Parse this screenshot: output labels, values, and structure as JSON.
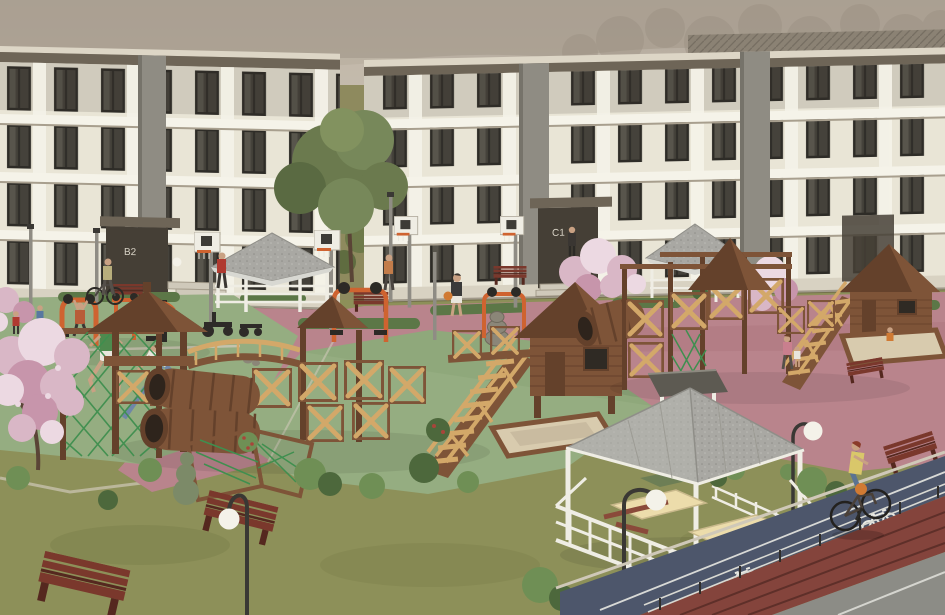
{
  "scene": {
    "title": "Residential complex courtyard - architectural 3D render",
    "description": "Courtyard of a housing estate with wooden playground complexes, outdoor gym, basketball hoops, gazebos, picnic pavilion, green and pink rubber surfaces, lawns and a bicycle path with painted bike symbols"
  },
  "labels": {
    "building_left": "B2",
    "building_center": "C1"
  },
  "palette": {
    "sky1": "#b4aa9d",
    "sky2": "#cfc5b6",
    "hill": "#a29788",
    "hillDark": "#988d7f",
    "facade": "#e9e5d6",
    "trim": "#f5f3e9",
    "roofDark": "#6e6557",
    "roofEdge": "#ddd6c6",
    "roofTile": "#8b8274",
    "winFrame": "#2e2c27",
    "winGlass": "#45423b",
    "winLite": "#6b675e",
    "column": "#8f8c83",
    "entrance": "#453f36",
    "plinth": "#d8d2c2",
    "grass": "#8d9059",
    "grassDark": "#767c46",
    "pink": "#b9848c",
    "pinkDark": "#a86f78",
    "green": "#95ad81",
    "greenDark": "#7f9a6c",
    "hedge": "#5c7747",
    "bush": "#6f8f55",
    "bushDark": "#4d683c",
    "bushGray": "#7c8a68",
    "blossom": "#d9b7c6",
    "blossomDeep": "#c795ab",
    "blossomLite": "#ecd9e2",
    "redBush": "#a8453a",
    "woodDark": "#64412b",
    "woodMid": "#7e5438",
    "woodLight": "#9a6b45",
    "woodPale": "#d3a869",
    "net": "#3f8f4f",
    "gazeboRoof": "#a9a8a3",
    "gazeboRoof2": "#999892",
    "white": "#efede4",
    "sand": "#d8cbae",
    "orange": "#cf6330",
    "black": "#2c2a26",
    "bench": "#7a382c",
    "benchDark": "#55281f",
    "pole": "#8f8c84",
    "poleDark": "#3a3834",
    "globe": "#f4f2e9",
    "path": "#4d566b",
    "pathLine": "#e8e8e2",
    "track": "#84443c",
    "trackLine": "#5e2f29",
    "roadGray": "#8c8c86",
    "skin": "#c9a183",
    "curb": "#cfc8b8",
    "stone": "#8b8678",
    "trunk": "#5a4436",
    "treeGreen": "#6b7a4e"
  },
  "objects": [
    {
      "name": "apartment-building-left",
      "label": "B2",
      "floors": 4
    },
    {
      "name": "apartment-building-center",
      "label": "C1",
      "floors": 4
    },
    {
      "name": "basketball-hoops",
      "count": 4
    },
    {
      "name": "small-gazebos",
      "count": 2
    },
    {
      "name": "picnic-gazebo",
      "count": 1
    },
    {
      "name": "wooden-playground-complexes",
      "count": 2
    },
    {
      "name": "playhouse-towers",
      "count": 2
    },
    {
      "name": "log-tunnels",
      "count": 3
    },
    {
      "name": "sandboxes",
      "count": 2
    },
    {
      "name": "outdoor-gym-stations",
      "count": 5
    },
    {
      "name": "benches",
      "count": 8
    },
    {
      "name": "globe-street-lamps",
      "count": 3
    },
    {
      "name": "court-light-poles",
      "count": 4
    },
    {
      "name": "bike-path",
      "markings": "white bicycle symbols and lane line"
    },
    {
      "name": "running-track",
      "lanes": 4
    }
  ],
  "people": [
    {
      "name": "cyclist-on-bike-path",
      "desc": "woman with orange bag riding along the path"
    },
    {
      "name": "man-exercising",
      "desc": "green shirt, lunging at gym area"
    },
    {
      "name": "woman-stretching",
      "desc": "white top, blue leggings"
    },
    {
      "name": "person-hanging-on-bar"
    },
    {
      "name": "person-with-basketball"
    },
    {
      "name": "person-walking-bicycle"
    },
    {
      "name": "person-in-red-jacket"
    },
    {
      "name": "person-in-orange-shirt"
    },
    {
      "name": "person-at-entrance"
    },
    {
      "name": "mother-and-child"
    },
    {
      "name": "toddler-in-sandbox"
    },
    {
      "name": "children-playing",
      "count": 2
    },
    {
      "name": "people-in-gazebo",
      "count": 2
    }
  ]
}
